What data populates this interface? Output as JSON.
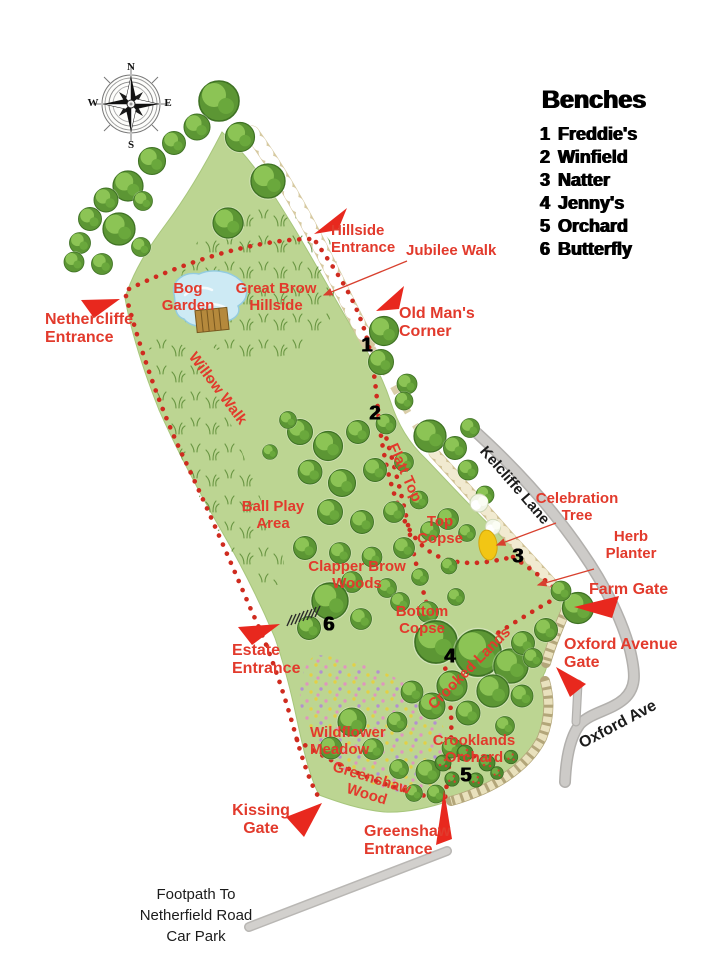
{
  "legend": {
    "title": "Benches",
    "items": [
      {
        "num": "1",
        "name": "Freddie's"
      },
      {
        "num": "2",
        "name": "Winfield"
      },
      {
        "num": "3",
        "name": "Natter"
      },
      {
        "num": "4",
        "name": "Jenny's"
      },
      {
        "num": "5",
        "name": "Orchard"
      },
      {
        "num": "6",
        "name": "Butterfly"
      }
    ]
  },
  "compass": {
    "north": "N",
    "east": "E",
    "south": "S",
    "west": "W"
  },
  "entrances": {
    "hillside": "Hillside\nEntrance",
    "nethercliffe": "Nethercliffe\nEntrance",
    "estate": "Estate\nEntrance",
    "kissing_gate": "Kissing\nGate",
    "greenshaw": "Greenshaw\nEntrance",
    "farm_gate": "Farm Gate",
    "oxford_avenue_gate": "Oxford Avenue\nGate"
  },
  "areas": {
    "bog_garden": "Bog\nGarden",
    "great_brow_hillside": "Great Brow\nHillside",
    "old_mans_corner": "Old Man's\nCorner",
    "jubilee_walk": "Jubilee Walk",
    "willow_walk": "Willow Walk",
    "flatt_top": "Flatt Top",
    "ball_play_area": "Ball Play\nArea",
    "top_copse": "Top\nCopse",
    "celebration_tree": "Celebration\nTree",
    "herb_planter": "Herb\nPlanter",
    "clapper_brow_woods": "Clapper Brow\nWoods",
    "bottom_copse": "Bottom\nCopse",
    "crooked_lands": "Crooked Lands",
    "wildflower_meadow": "Wildflower\nMeadow",
    "crooklands_orchard": "Crooklands\nOrchard",
    "greenshaw_wood": "Greenshaw\nWood"
  },
  "roads": {
    "kelcliffe_lane": "Kelcliffe Lane",
    "oxford_ave": "Oxford Ave"
  },
  "notes": {
    "footpath": "Footpath To\nNetherfield Road\nCar Park"
  },
  "colors": {
    "label_red": "#e23a2c",
    "flag_red": "#e8281e",
    "path_dot_red": "#cf2b1f",
    "park_green": "#bcd592",
    "tree_green": "#5c9634",
    "road_gray": "#c6c4c1",
    "pond_blue": "#cdeaf4",
    "celebration_yellow": "#f2c614",
    "text_black": "#1b1b1b"
  }
}
